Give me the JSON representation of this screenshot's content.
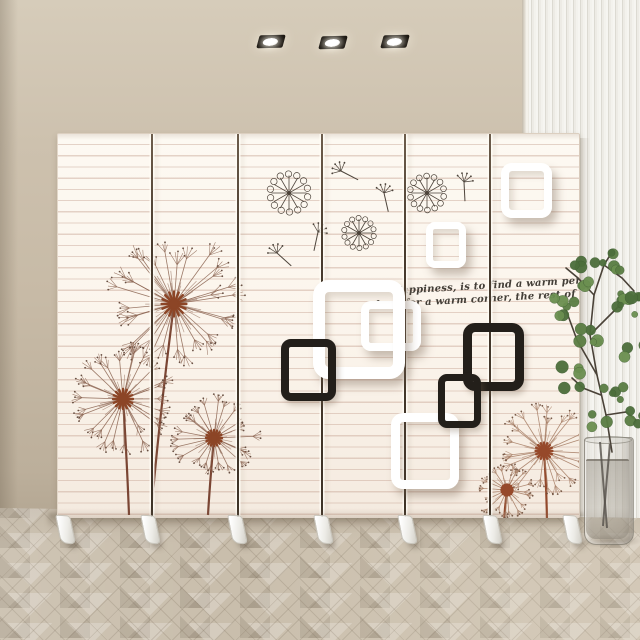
{
  "scene": {
    "subject": "6-panel folding screen room divider with dandelion wall-art print, in a room with beige wall, white slat accent wall, herringbone wood floor and a glass vase plant",
    "screen": {
      "panel_count": 6,
      "feet_count": 7
    },
    "ceiling_lights": {
      "count": 3
    }
  },
  "quote": {
    "line1": "Happiness, is to find a warm person,",
    "line2": "look for a warm corner, the rest of my life."
  },
  "colors": {
    "wall_beige": "#c9bca9",
    "slat_wall": "#f0eee8",
    "screen_cream": "#fbf5ec",
    "screen_stripe": "#cbacb9c",
    "panel_seam": "#42382e",
    "dandelion_left_filament": "#8b6451",
    "dandelion_right_filament": "#a57c63",
    "dandelion_center": "#8c4526",
    "stem_left": "#7a4533",
    "stem_right": "#93492c",
    "square_black": "#231f1a",
    "square_white": "#ffffff",
    "quote_text": "#433e37",
    "floor_wood": "#c9beac",
    "plant_green": "#5a7d43",
    "vase_glass": "#aaa69c"
  },
  "artwork": {
    "lights": [
      {
        "x": 258,
        "y": 35
      },
      {
        "x": 320,
        "y": 36
      },
      {
        "x": 382,
        "y": 35
      }
    ],
    "seams_x": [
      150,
      236,
      320,
      403,
      488
    ],
    "feet_x": [
      64,
      149,
      236,
      322,
      406,
      491,
      571
    ],
    "squares": [
      {
        "x": 303,
        "y": 167,
        "w": 60,
        "h": 50,
        "b": 8,
        "c": "white",
        "r": 10,
        "z": 1
      },
      {
        "x": 255,
        "y": 146,
        "w": 92,
        "h": 99,
        "b": 12,
        "c": "white",
        "r": 16,
        "z": 2
      },
      {
        "x": 223,
        "y": 205,
        "w": 55,
        "h": 62,
        "b": 8,
        "c": "black",
        "r": 10,
        "z": 3
      },
      {
        "x": 443,
        "y": 29,
        "w": 51,
        "h": 55,
        "b": 8,
        "c": "white",
        "r": 11,
        "z": 2
      },
      {
        "x": 368,
        "y": 88,
        "w": 40,
        "h": 46,
        "b": 7,
        "c": "white",
        "r": 9,
        "z": 2
      },
      {
        "x": 333,
        "y": 279,
        "w": 68,
        "h": 76,
        "b": 9,
        "c": "white",
        "r": 12,
        "z": 2
      },
      {
        "x": 405,
        "y": 189,
        "w": 61,
        "h": 68,
        "b": 9,
        "c": "black",
        "r": 12,
        "z": 3
      },
      {
        "x": 380,
        "y": 240,
        "w": 43,
        "h": 54,
        "b": 7,
        "c": "black",
        "r": 9,
        "z": 4
      }
    ],
    "dandelions": [
      {
        "cx": 173,
        "cy": 303,
        "r": 62,
        "spokes": 30,
        "palette": "left",
        "stem": [
          [
            173,
            303
          ],
          [
            158,
            420
          ],
          [
            150,
            514
          ]
        ]
      },
      {
        "cx": 122,
        "cy": 398,
        "r": 50,
        "spokes": 26,
        "palette": "left",
        "stem": [
          [
            122,
            398
          ],
          [
            126,
            460
          ],
          [
            128,
            514
          ]
        ]
      },
      {
        "cx": 213,
        "cy": 437,
        "r": 40,
        "spokes": 22,
        "palette": "left",
        "stem": [
          [
            213,
            437
          ],
          [
            209,
            480
          ],
          [
            207,
            514
          ]
        ]
      },
      {
        "cx": 543,
        "cy": 450,
        "r": 42,
        "spokes": 24,
        "palette": "right",
        "stem": [
          [
            543,
            450
          ],
          [
            546,
            495
          ],
          [
            546,
            529
          ]
        ]
      },
      {
        "cx": 506,
        "cy": 489,
        "r": 28,
        "spokes": 18,
        "palette": "right",
        "stem": [
          [
            506,
            489
          ],
          [
            503,
            512
          ],
          [
            503,
            529
          ]
        ]
      }
    ],
    "wheel_flowers": [
      {
        "cx": 288,
        "cy": 192,
        "r": 19
      },
      {
        "cx": 358,
        "cy": 232,
        "r": 15
      },
      {
        "cx": 426,
        "cy": 192,
        "r": 17
      }
    ],
    "floating_seeds": [
      {
        "x": 340,
        "y": 170,
        "rot": -35
      },
      {
        "x": 383,
        "y": 192,
        "rot": 15
      },
      {
        "x": 317,
        "y": 231,
        "rot": 40
      },
      {
        "x": 276,
        "y": 252,
        "rot": -20
      },
      {
        "x": 463,
        "y": 181,
        "rot": 25
      }
    ],
    "plant": {
      "branches": [
        [
          [
            612,
            452
          ],
          [
            606,
            415
          ],
          [
            597,
            375
          ],
          [
            590,
            335
          ],
          [
            594,
            295
          ],
          [
            604,
            265
          ],
          [
            612,
            252
          ]
        ],
        [
          [
            597,
            375
          ],
          [
            577,
            340
          ],
          [
            566,
            310
          ]
        ],
        [
          [
            590,
            335
          ],
          [
            610,
            315
          ],
          [
            625,
            300
          ]
        ],
        [
          [
            594,
            295
          ],
          [
            578,
            278
          ],
          [
            566,
            268
          ]
        ],
        [
          [
            604,
            265
          ],
          [
            622,
            278
          ],
          [
            634,
            291
          ]
        ],
        [
          [
            606,
            415
          ],
          [
            626,
            412
          ],
          [
            636,
            420
          ]
        ],
        [
          [
            601,
            395
          ],
          [
            583,
            388
          ],
          [
            572,
            378
          ]
        ]
      ],
      "leaf_clusters": [
        {
          "x": 566,
          "y": 306,
          "n": 6,
          "r": 14
        },
        {
          "x": 585,
          "y": 271,
          "n": 7,
          "r": 16
        },
        {
          "x": 610,
          "y": 258,
          "n": 6,
          "r": 14
        },
        {
          "x": 630,
          "y": 292,
          "n": 5,
          "r": 13
        },
        {
          "x": 571,
          "y": 377,
          "n": 5,
          "r": 12
        },
        {
          "x": 592,
          "y": 342,
          "n": 6,
          "r": 14
        },
        {
          "x": 623,
          "y": 306,
          "n": 5,
          "r": 12
        },
        {
          "x": 636,
          "y": 350,
          "n": 5,
          "r": 12
        },
        {
          "x": 612,
          "y": 390,
          "n": 5,
          "r": 12
        },
        {
          "x": 634,
          "y": 418,
          "n": 4,
          "r": 11
        },
        {
          "x": 600,
          "y": 418,
          "n": 3,
          "r": 10
        }
      ],
      "vase_stems": [
        [
          [
            600,
            442
          ],
          [
            604,
            490
          ],
          [
            607,
            528
          ]
        ],
        [
          [
            610,
            444
          ],
          [
            606,
            486
          ],
          [
            603,
            526
          ]
        ]
      ]
    }
  }
}
